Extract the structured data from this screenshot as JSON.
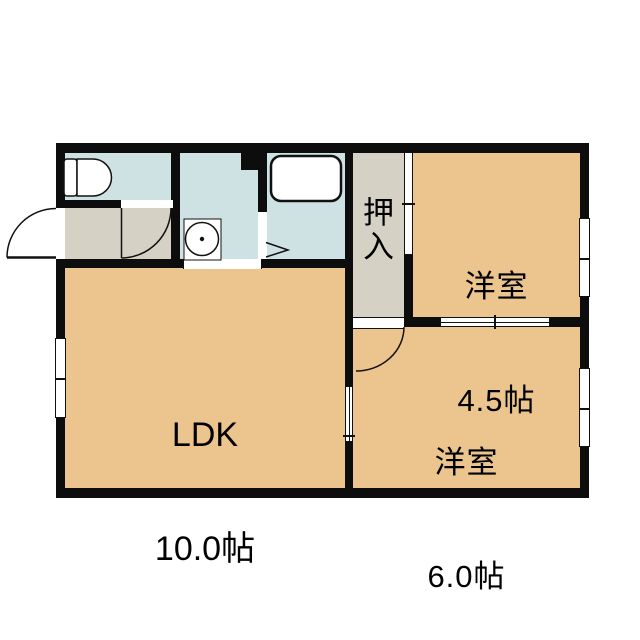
{
  "plan": {
    "type": "apartment-floor-plan",
    "rooms": {
      "ldk": {
        "name": "LDK",
        "size": "10.0帖"
      },
      "western_45": {
        "name": "洋室",
        "size": "4.5帖"
      },
      "western_60": {
        "name": "洋室",
        "size": "6.0帖"
      },
      "closet": {
        "name": "押入"
      }
    },
    "colors": {
      "wall": "#0d0d0d",
      "room_tan": "#ebc58d",
      "wet_blue": "#cfe2e3",
      "hall_gray": "#d5d1c5",
      "bg": "#ffffff"
    },
    "icons": {
      "toilet": "toilet-icon",
      "bathtub": "bathtub-icon",
      "washing_machine": "washing-machine-icon",
      "bath_door": "folding-door-arrow-icon",
      "swing_door": "swing-door-arc-icon",
      "sliding_door": "sliding-door-symbol",
      "window": "sliding-window-symbol"
    }
  }
}
